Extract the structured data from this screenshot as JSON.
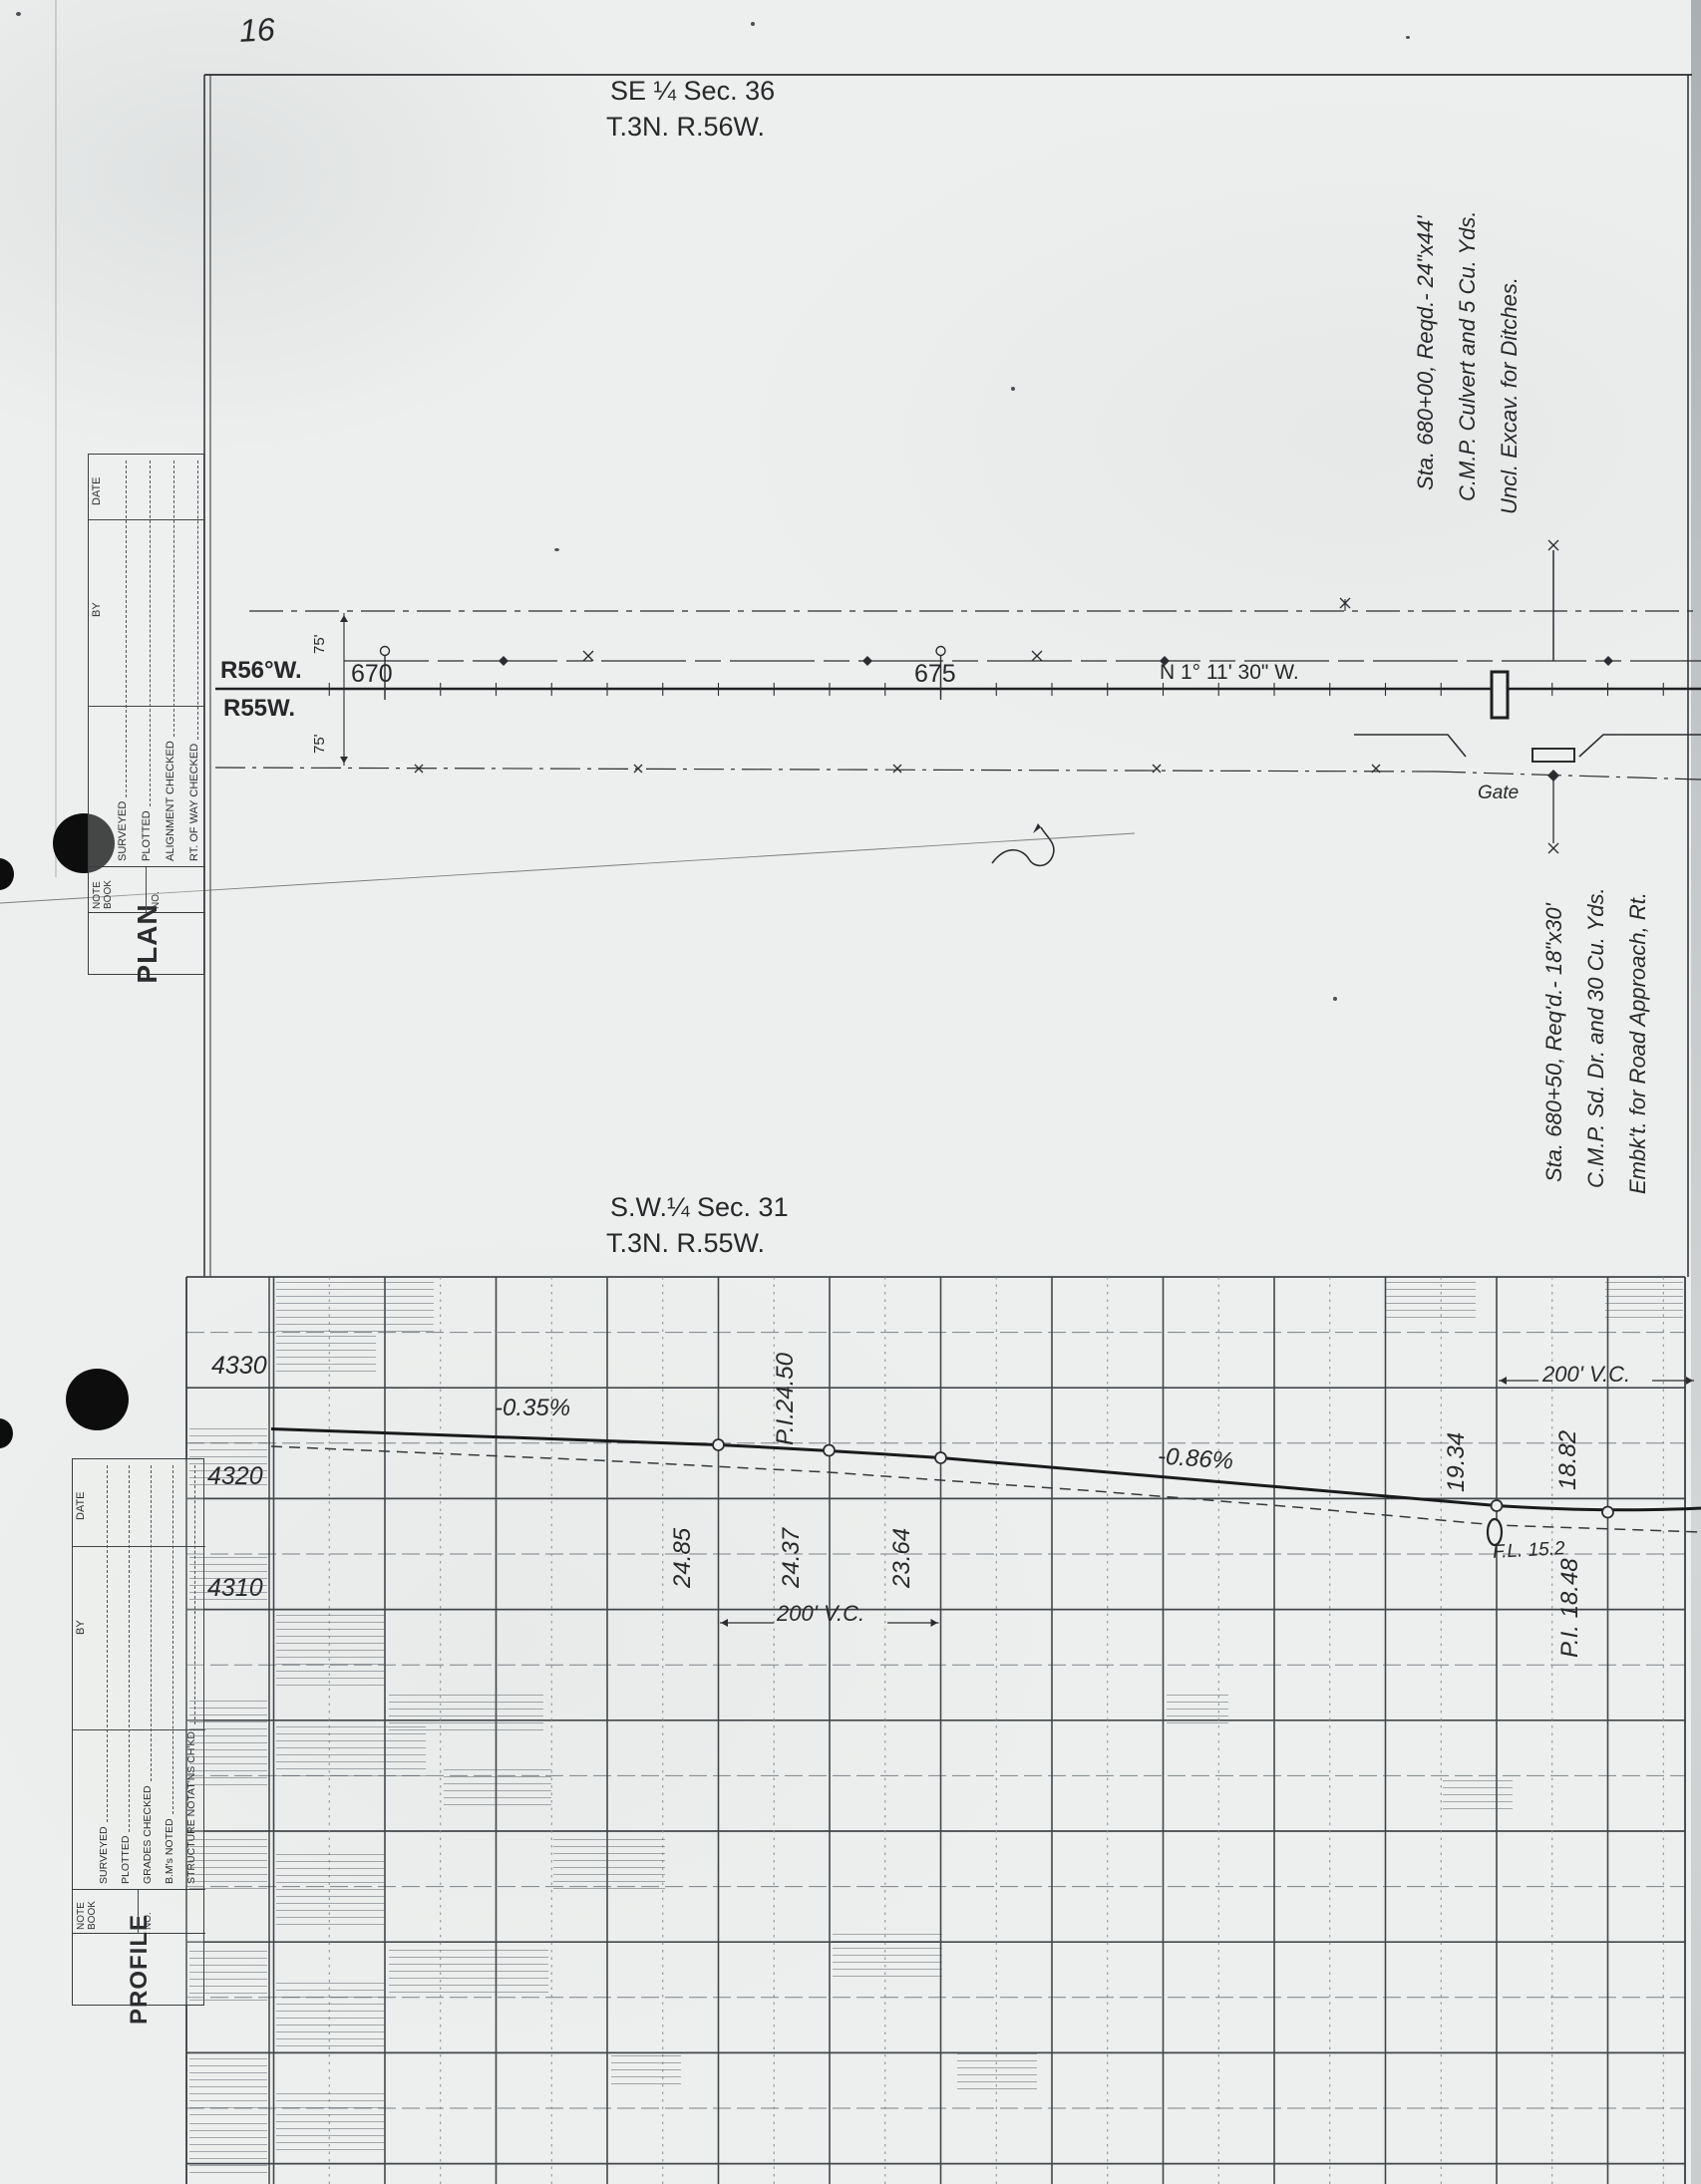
{
  "page": {
    "number": "16"
  },
  "plan": {
    "title1": "SE ¼ Sec. 36",
    "title2": "T.3N.  R.56W.",
    "range_top": "R56°W.",
    "range_bottom": "R55W.",
    "stations": [
      "670",
      "675"
    ],
    "bearing": "N 1° 11' 30\" W.",
    "offset_top": "75'",
    "offset_bottom": "75'",
    "gate": "Gate",
    "note_culvert": {
      "line1": "Sta. 680+00, Reqd.- 24\"x44'",
      "line2": "C.M.P. Culvert and 5 Cu. Yds.",
      "line3": "Uncl. Excav. for Ditches."
    },
    "note_side_drain": {
      "line1": "Sta. 680+50, Req'd.- 18\"x30'",
      "line2": "C.M.P. Sd. Dr. and 30 Cu. Yds.",
      "line3": "Embk't. for Road Approach, Rt."
    },
    "block": {
      "title": "PLAN",
      "notebook": "NOTE BOOK",
      "no": "NO.",
      "by": "BY",
      "date": "DATE",
      "rows": [
        "SURVEYED",
        "PLOTTED",
        "ALIGNMENT CHECKED",
        "RT. OF WAY CHECKED"
      ]
    }
  },
  "profile": {
    "title1": "S.W.¼ Sec. 31",
    "title2": "T.3N.  R.55W.",
    "block": {
      "title": "PROFILE",
      "notebook": "NOTE BOOK",
      "no": "NO.",
      "by": "BY",
      "date": "DATE",
      "rows": [
        "SURVEYED",
        "PLOTTED",
        "GRADES CHECKED",
        "B.M's NOTED",
        "STRUCTURE NOTAT'NS CH'KD."
      ]
    },
    "labels": {
      "elevations": [
        "4330",
        "4320",
        "4310"
      ],
      "grade1": "-0.35%",
      "grade2": "-0.86%",
      "pi1": "P.I.24.50",
      "points": [
        "24.85",
        "24.37",
        "23.64",
        "19.34",
        "18.82"
      ],
      "pi2": "P.I. 18.48",
      "flowline": "F.L. 15.2",
      "vc1": "200' V.C.",
      "vc2": "200' V.C."
    }
  },
  "chart_data": {
    "type": "line",
    "title": "Roadway profile grade line, SW ¼ Sec. 31, T.3N. R.55W.",
    "ylabel": "Elevation (ft)",
    "yticks": [
      4330,
      4320,
      4310
    ],
    "ylim": [
      4230,
      4335
    ],
    "grid": true,
    "legend_position": "none",
    "series": [
      {
        "name": "grade line",
        "style": "solid",
        "points": [
          {
            "station": "approx 669+00",
            "elevation": 4326.3
          },
          {
            "station": "673+00",
            "elevation": 4324.85,
            "label": "24.85",
            "note": "begin 200' V.C."
          },
          {
            "station": "674+00",
            "elevation": 4324.37,
            "label": "24.37",
            "note": "P.I.24.50"
          },
          {
            "station": "675+00",
            "elevation": 4323.64,
            "label": "23.64",
            "note": "end 200' V.C."
          },
          {
            "station": "680+00",
            "elevation": 4319.34,
            "label": "19.34",
            "note": "begin 200' V.C."
          },
          {
            "station": "681+00",
            "elevation": 4318.82,
            "label": "18.82",
            "note": "P.I. 18.48"
          }
        ]
      },
      {
        "name": "existing ground",
        "style": "dashed",
        "points": []
      }
    ],
    "grades": [
      "-0.35%",
      "-0.86%"
    ],
    "vertical_curves": [
      {
        "label": "200' V.C.",
        "span": "673+00 to 675+00"
      },
      {
        "label": "200' V.C.",
        "span": "680+00 to 682+00"
      }
    ],
    "annotations": [
      "P.I.24.50",
      "P.I. 18.48",
      "F.L. 15.2",
      "-0.35%",
      "-0.86%"
    ]
  }
}
